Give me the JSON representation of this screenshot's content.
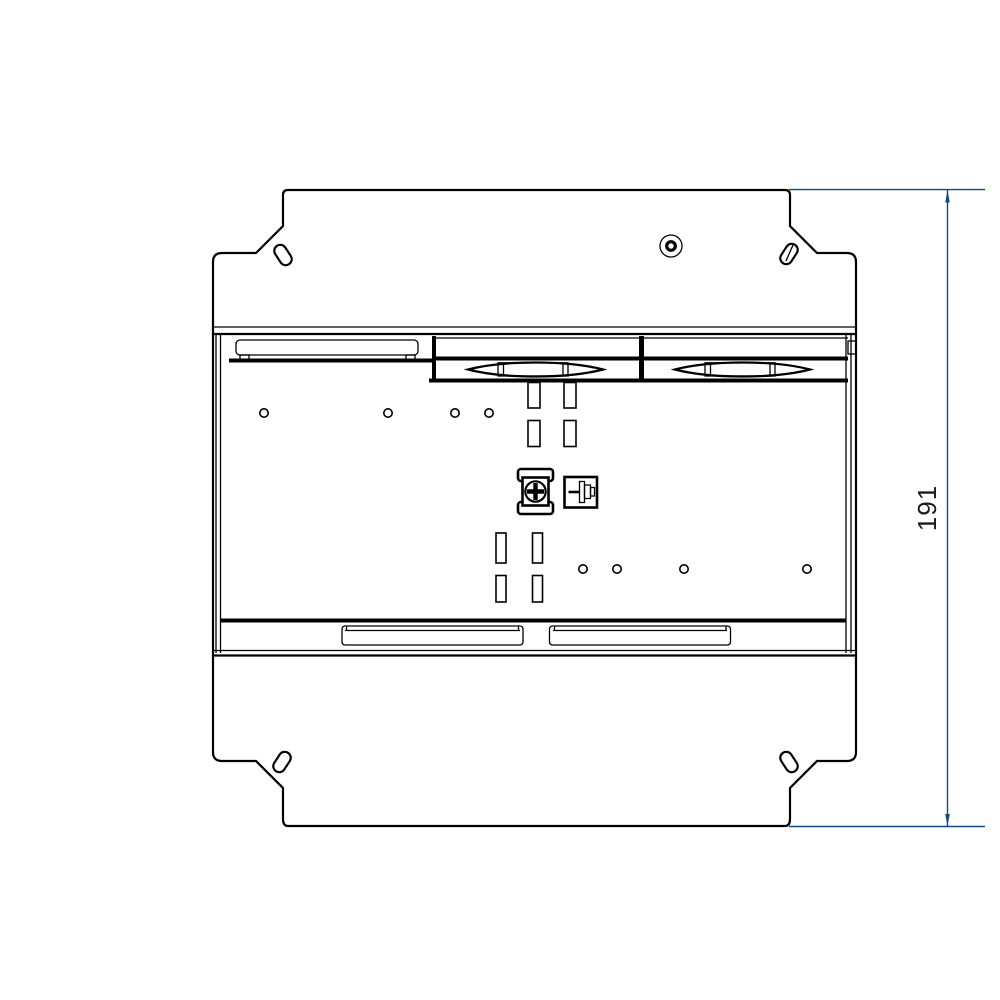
{
  "drawing": {
    "kind": "technical-drawing-top-view",
    "dimension": {
      "value": "191",
      "orientation": "vertical",
      "side": "right"
    },
    "colors": {
      "line": "#000000",
      "dimension_line": "#0d4a7e",
      "dimension_text": "#1c1c1c",
      "background": "#ffffff"
    }
  }
}
